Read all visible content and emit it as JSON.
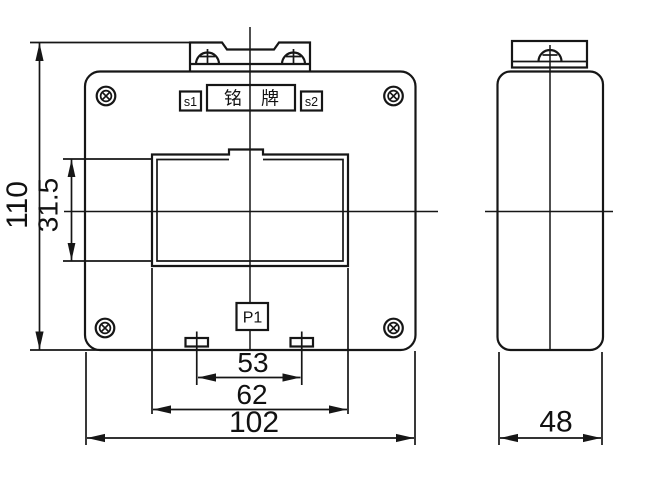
{
  "front_view": {
    "terminal_labels": {
      "s1": "s1",
      "s2": "s2"
    },
    "nameplate_text": "铭牌",
    "p1_terminal_label": "P1",
    "dimensions": {
      "overall_height": "110",
      "window_height": "31.5",
      "mounting_hole_spacing": "53",
      "window_width": "62",
      "overall_width": "102"
    }
  },
  "side_view": {
    "dimensions": {
      "overall_depth": "48"
    }
  },
  "colors": {
    "line": "#161616",
    "background": "#ffffff"
  }
}
